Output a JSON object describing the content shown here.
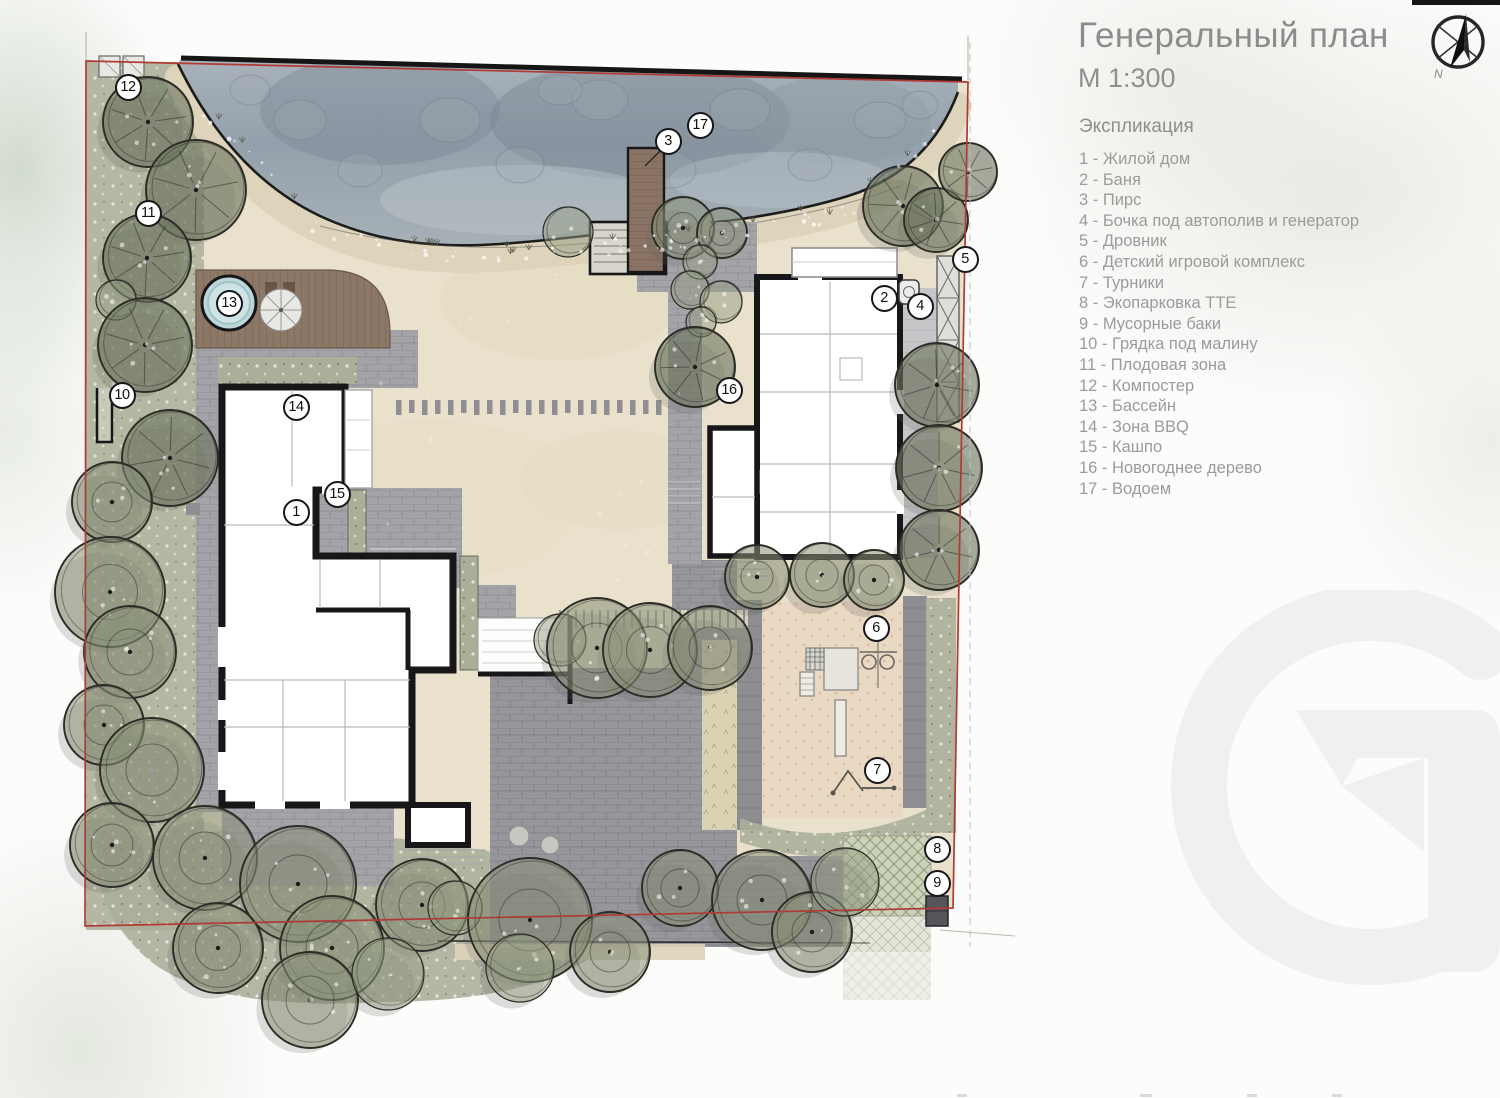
{
  "title_block": {
    "title": "Генеральный план",
    "scale": "М 1:300"
  },
  "compass": {
    "label": "N"
  },
  "legend": {
    "heading": "Экспликация",
    "items": [
      "1 - Жилой дом",
      "2 - Баня",
      "3 - Пирс",
      "4 - Бочка под автополив и генератор",
      "5 - Дровник",
      "6 - Детский игровой комплекс",
      "7 - Турники",
      "8 - Экопарковка ТТЕ",
      "9 - Мусорные баки",
      "10 - Грядка под малину",
      "11 - Плодовая зона",
      "12 - Компостер",
      "13 - Бассейн",
      "14 - Зона BBQ",
      "15 - Кашпо",
      "16 - Новогоднее дерево",
      "17 - Водоем"
    ]
  },
  "plan": {
    "markers": [
      {
        "n": "1",
        "x": 296,
        "y": 512
      },
      {
        "n": "2",
        "x": 884,
        "y": 298
      },
      {
        "n": "3",
        "x": 668,
        "y": 141
      },
      {
        "n": "4",
        "x": 920,
        "y": 306
      },
      {
        "n": "5",
        "x": 965,
        "y": 259
      },
      {
        "n": "6",
        "x": 876,
        "y": 628
      },
      {
        "n": "7",
        "x": 877,
        "y": 770
      },
      {
        "n": "8",
        "x": 937,
        "y": 849
      },
      {
        "n": "9",
        "x": 937,
        "y": 883
      },
      {
        "n": "10",
        "x": 122,
        "y": 395
      },
      {
        "n": "11",
        "x": 148,
        "y": 213
      },
      {
        "n": "12",
        "x": 128,
        "y": 87
      },
      {
        "n": "13",
        "x": 229,
        "y": 303
      },
      {
        "n": "14",
        "x": 296,
        "y": 407
      },
      {
        "n": "15",
        "x": 337,
        "y": 494
      },
      {
        "n": "16",
        "x": 729,
        "y": 390
      },
      {
        "n": "17",
        "x": 700,
        "y": 125
      }
    ]
  },
  "watermark": {
    "letter": "G"
  },
  "colors": {
    "boundary_red": "#b03a35",
    "water": "#97a3ad",
    "wall_black": "#17171a",
    "text_gray": "#9b9b9b"
  }
}
